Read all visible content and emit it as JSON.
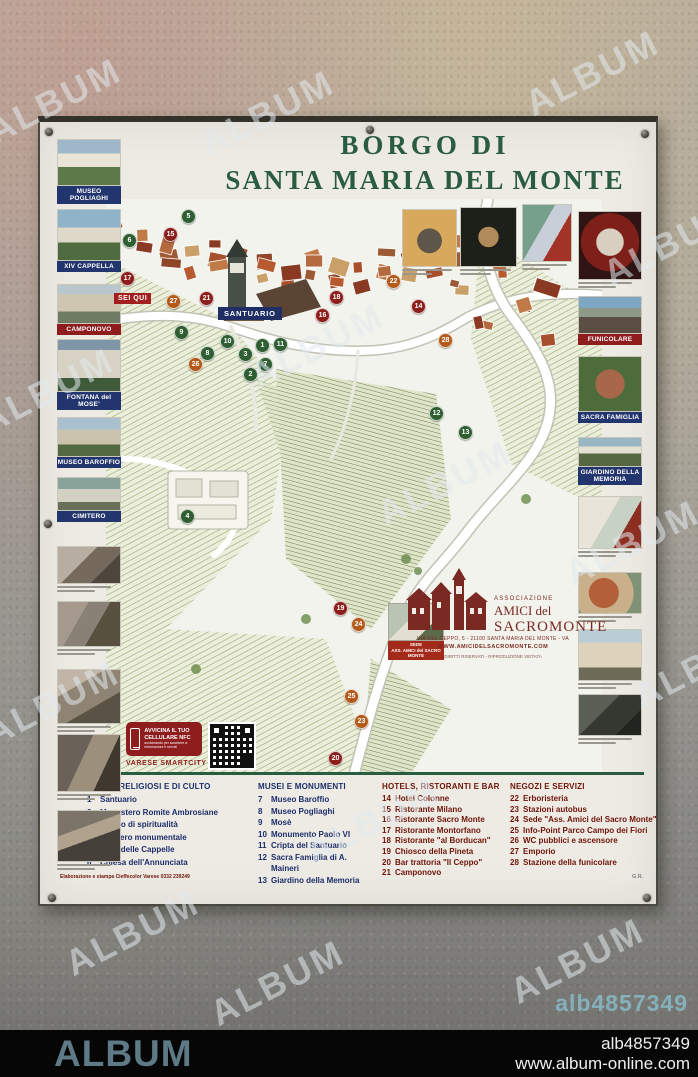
{
  "header": {
    "title_line1": "BORGO DI",
    "title_line2": "SANTA MARIA DEL MONTE"
  },
  "left_rail": [
    {
      "style": "p-villa",
      "label": "MUSEO POGLIAGHI",
      "label_color": "navy",
      "top": 17,
      "h": 47
    },
    {
      "style": "p-chapel",
      "label": "XIV CAPPELLA",
      "label_color": "navy",
      "top": 87,
      "h": 52
    },
    {
      "style": "p-camponovo",
      "label": "CAMPONOVO",
      "label_color": "red",
      "top": 162,
      "h": 40
    },
    {
      "style": "p-monument",
      "label": "FONTANA del MOSE'",
      "label_color": "navy",
      "top": 217,
      "h": 53
    },
    {
      "style": "p-columns",
      "label": "MUSEO BAROFFIO",
      "label_color": "navy",
      "top": 295,
      "h": 40
    },
    {
      "style": "p-cemetery",
      "label": "CIMITERO",
      "label_color": "navy",
      "top": 355,
      "h": 34
    },
    {
      "style": "p-street1",
      "caption": true,
      "top": 424,
      "h": 38
    },
    {
      "style": "p-street2",
      "caption": true,
      "top": 479,
      "h": 46
    },
    {
      "style": "p-street3",
      "caption": true,
      "top": 547,
      "h": 55
    },
    {
      "style": "p-street4",
      "caption": true,
      "top": 612,
      "h": 58
    },
    {
      "style": "p-street5",
      "caption": true,
      "top": 688,
      "h": 52
    }
  ],
  "right_rail": [
    {
      "style": "p-artred",
      "caption": true,
      "top": 89,
      "h": 69
    },
    {
      "style": "p-funicular",
      "label": "FUNICOLARE",
      "label_color": "red",
      "top": 174,
      "h": 38
    },
    {
      "style": "p-sacra",
      "label": "SACRA FAMIGLIA",
      "label_color": "navy",
      "top": 234,
      "h": 56
    },
    {
      "style": "p-giardino",
      "label": "GIARDINO DELLA MEMORIA",
      "label_color": "navy",
      "top": 315,
      "h": 30
    },
    {
      "style": "p-painting",
      "caption": true,
      "top": 374,
      "h": 53
    },
    {
      "style": "p-fresco",
      "caption": true,
      "top": 450,
      "h": 42
    },
    {
      "style": "p-facade",
      "caption": true,
      "top": 507,
      "h": 52
    },
    {
      "style": "p-etching",
      "caption": true,
      "top": 572,
      "h": 42
    }
  ],
  "top_row": [
    {
      "style": "p-statuetan",
      "left": 362,
      "top": 87,
      "w": 55,
      "h": 58
    },
    {
      "style": "p-statuedark",
      "left": 420,
      "top": 85,
      "w": 57,
      "h": 60
    },
    {
      "style": "p-paintgr",
      "left": 482,
      "top": 82,
      "w": 50,
      "h": 58
    }
  ],
  "map": {
    "you_are_here": "SEI QUI",
    "santuario_label": "SANTUARIO",
    "sede_label_line1": "SEDE",
    "sede_label_line2": "ASS. AMICI del SACRO MONTE",
    "markers": [
      {
        "n": 5,
        "type": "green",
        "x": 75,
        "y": 10
      },
      {
        "n": 6,
        "type": "green",
        "x": 16,
        "y": 34
      },
      {
        "n": 15,
        "type": "red",
        "x": 57,
        "y": 28
      },
      {
        "n": 17,
        "type": "red",
        "x": 14,
        "y": 72
      },
      {
        "n": 27,
        "type": "orange",
        "x": 60,
        "y": 95
      },
      {
        "n": 21,
        "type": "red",
        "x": 93,
        "y": 92
      },
      {
        "n": 22,
        "type": "orange",
        "x": 280,
        "y": 75
      },
      {
        "n": 9,
        "type": "green",
        "x": 68,
        "y": 126
      },
      {
        "n": 10,
        "type": "green",
        "x": 114,
        "y": 135
      },
      {
        "n": 8,
        "type": "green",
        "x": 94,
        "y": 147
      },
      {
        "n": 7,
        "type": "green",
        "x": 152,
        "y": 158
      },
      {
        "n": 3,
        "type": "green",
        "x": 132,
        "y": 148
      },
      {
        "n": 2,
        "type": "green",
        "x": 137,
        "y": 168
      },
      {
        "n": 1,
        "type": "green",
        "x": 149,
        "y": 139
      },
      {
        "n": 11,
        "type": "green",
        "x": 167,
        "y": 138
      },
      {
        "n": 26,
        "type": "orange",
        "x": 82,
        "y": 158
      },
      {
        "n": 16,
        "type": "red",
        "x": 209,
        "y": 109
      },
      {
        "n": 18,
        "type": "red",
        "x": 223,
        "y": 91
      },
      {
        "n": 14,
        "type": "red",
        "x": 305,
        "y": 100
      },
      {
        "n": 28,
        "type": "orange",
        "x": 332,
        "y": 134
      },
      {
        "n": 12,
        "type": "green",
        "x": 323,
        "y": 207
      },
      {
        "n": 13,
        "type": "green",
        "x": 352,
        "y": 226
      },
      {
        "n": 4,
        "type": "green",
        "x": 74,
        "y": 310
      },
      {
        "n": 19,
        "type": "red",
        "x": 227,
        "y": 402
      },
      {
        "n": 24,
        "type": "orange",
        "x": 245,
        "y": 418
      },
      {
        "n": 25,
        "type": "orange",
        "x": 238,
        "y": 490
      },
      {
        "n": 23,
        "type": "orange",
        "x": 248,
        "y": 515
      },
      {
        "n": 20,
        "type": "red",
        "x": 222,
        "y": 552
      }
    ]
  },
  "association": {
    "line1": "ASSOCIAZIONE",
    "line2": "AMICI del",
    "line3": "SACROMONTE",
    "address": "VIA DEL CEPPO, 5 - 21100 SANTA MARIA DEL MONTE - VA",
    "website": "WWW.AMICIDELSACROMONTE.COM",
    "rights": "DIRITTI RISERVATI - RIPRODUZIONE VIETATA"
  },
  "nfc": {
    "line1": "AVVICINA IL TUO",
    "line2": "CELLULARE NFC",
    "sub": "avvicinando per accedere a informazioni e servizi",
    "brand": "VARESE SMARTCITY"
  },
  "legend": {
    "columns": [
      {
        "title": "EDIFICI RELIGIOSI E DI CULTO",
        "color": "lg-blue",
        "left": 47,
        "width": 166,
        "lh": 12.6,
        "items": [
          {
            "n": "1",
            "label": "Santuario"
          },
          {
            "n": "2",
            "label": "Monastero Romite Ambrosiane"
          },
          {
            "n": "3",
            "label": "Centro di spiritualità"
          },
          {
            "n": "4",
            "label": "Cimitero monumentale"
          },
          {
            "n": "5",
            "label": "Viale delle Cappelle"
          },
          {
            "n": "6",
            "label": "Chiesa dell'Annunciata"
          }
        ]
      },
      {
        "title": "MUSEI E MONUMENTI",
        "color": "lg-blue",
        "left": 218,
        "width": 118,
        "lh": 11.5,
        "items": [
          {
            "n": "7",
            "label": "Museo Baroffio"
          },
          {
            "n": "8",
            "label": "Museo Pogliaghi"
          },
          {
            "n": "9",
            "label": "Mosè"
          },
          {
            "n": "10",
            "label": "Monumento Paolo VI"
          },
          {
            "n": "11",
            "label": "Cripta del Santuario"
          },
          {
            "n": "12",
            "label": "Sacra Famiglia di A. Maineri"
          },
          {
            "n": "13",
            "label": "Giardino della Memoria"
          }
        ]
      },
      {
        "title": "HOTELS, RISTORANTI E BAR",
        "color": "lg-maroon",
        "left": 342,
        "width": 126,
        "lh": 10.6,
        "items": [
          {
            "n": "14",
            "label": "Hotel Colonne"
          },
          {
            "n": "15",
            "label": "Ristorante Milano"
          },
          {
            "n": "16",
            "label": "Ristorante Sacro Monte"
          },
          {
            "n": "17",
            "label": "Ristorante Montorfano"
          },
          {
            "n": "18",
            "label": "Ristorante \"al Borducan\""
          },
          {
            "n": "19",
            "label": "Chiosco della Pineta"
          },
          {
            "n": "20",
            "label": "Bar trattoria \"Il Ceppo\""
          },
          {
            "n": "21",
            "label": "Camponovo"
          }
        ]
      },
      {
        "title": "NEGOZI E SERVIZI",
        "color": "lg-maroon",
        "left": 470,
        "width": 148,
        "lh": 10.6,
        "items": [
          {
            "n": "22",
            "label": "Erboristeria"
          },
          {
            "n": "23",
            "label": "Stazioni autobus"
          },
          {
            "n": "24",
            "label": "Sede \"Ass. Amici del Sacro Monte\""
          },
          {
            "n": "25",
            "label": "Info-Point Parco Campo dei Fiori"
          },
          {
            "n": "26",
            "label": "WC pubblici e ascensore"
          },
          {
            "n": "27",
            "label": "Emporio"
          },
          {
            "n": "28",
            "label": "Stazione della funicolare"
          }
        ]
      }
    ],
    "credits": "Elaborazione e stampa Cieffecolor Varese 0332 239249",
    "initials": "G.R."
  },
  "watermark": {
    "text": "ALBUM",
    "wall_code": "alb4857349"
  },
  "footer": {
    "brand": "ALBUM",
    "code": "alb4857349",
    "url": "www.album-online.com"
  },
  "colors": {
    "title_green": "#2a5c40",
    "legend_blue": "#1d2d6b",
    "legend_maroon": "#701408",
    "label_navy": "#23356e",
    "label_red": "#8f1d1d",
    "marker_green": "#2f5e33",
    "marker_red": "#8c1f1c",
    "marker_orange": "#b35a1a",
    "footer_brand": "#5e7a87",
    "wall_code_blue": "#86b7c3"
  }
}
